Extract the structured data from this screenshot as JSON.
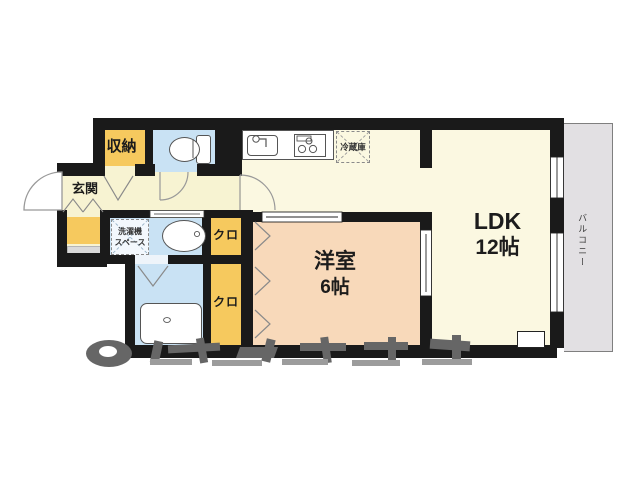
{
  "floorplan": {
    "rooms": {
      "ldk": {
        "label": "LDK",
        "size": "12帖"
      },
      "western_room": {
        "label": "洋室",
        "size": "6帖"
      },
      "entrance": {
        "label": "玄関"
      },
      "storage": {
        "label": "収納"
      },
      "closet_upper": {
        "label": "クロ"
      },
      "closet_lower": {
        "label": "クロ"
      },
      "balcony": {
        "label": "バルコニー"
      },
      "laundry_space": {
        "label_line1": "洗濯機",
        "label_line2": "スペース"
      },
      "refrigerator": {
        "label": "冷蔵庫"
      }
    },
    "colors": {
      "wall": "#1a1a1a",
      "hall_floor": "#f7f3d2",
      "ldk_floor": "#fbf8e1",
      "bedroom_floor": "#f8d9ba",
      "wet_area_floor": "#c9e2f4",
      "storage_fill": "#f6c95e",
      "balcony_fill": "#e2e0e3",
      "watermark_gray": "#6b6b6b"
    }
  }
}
